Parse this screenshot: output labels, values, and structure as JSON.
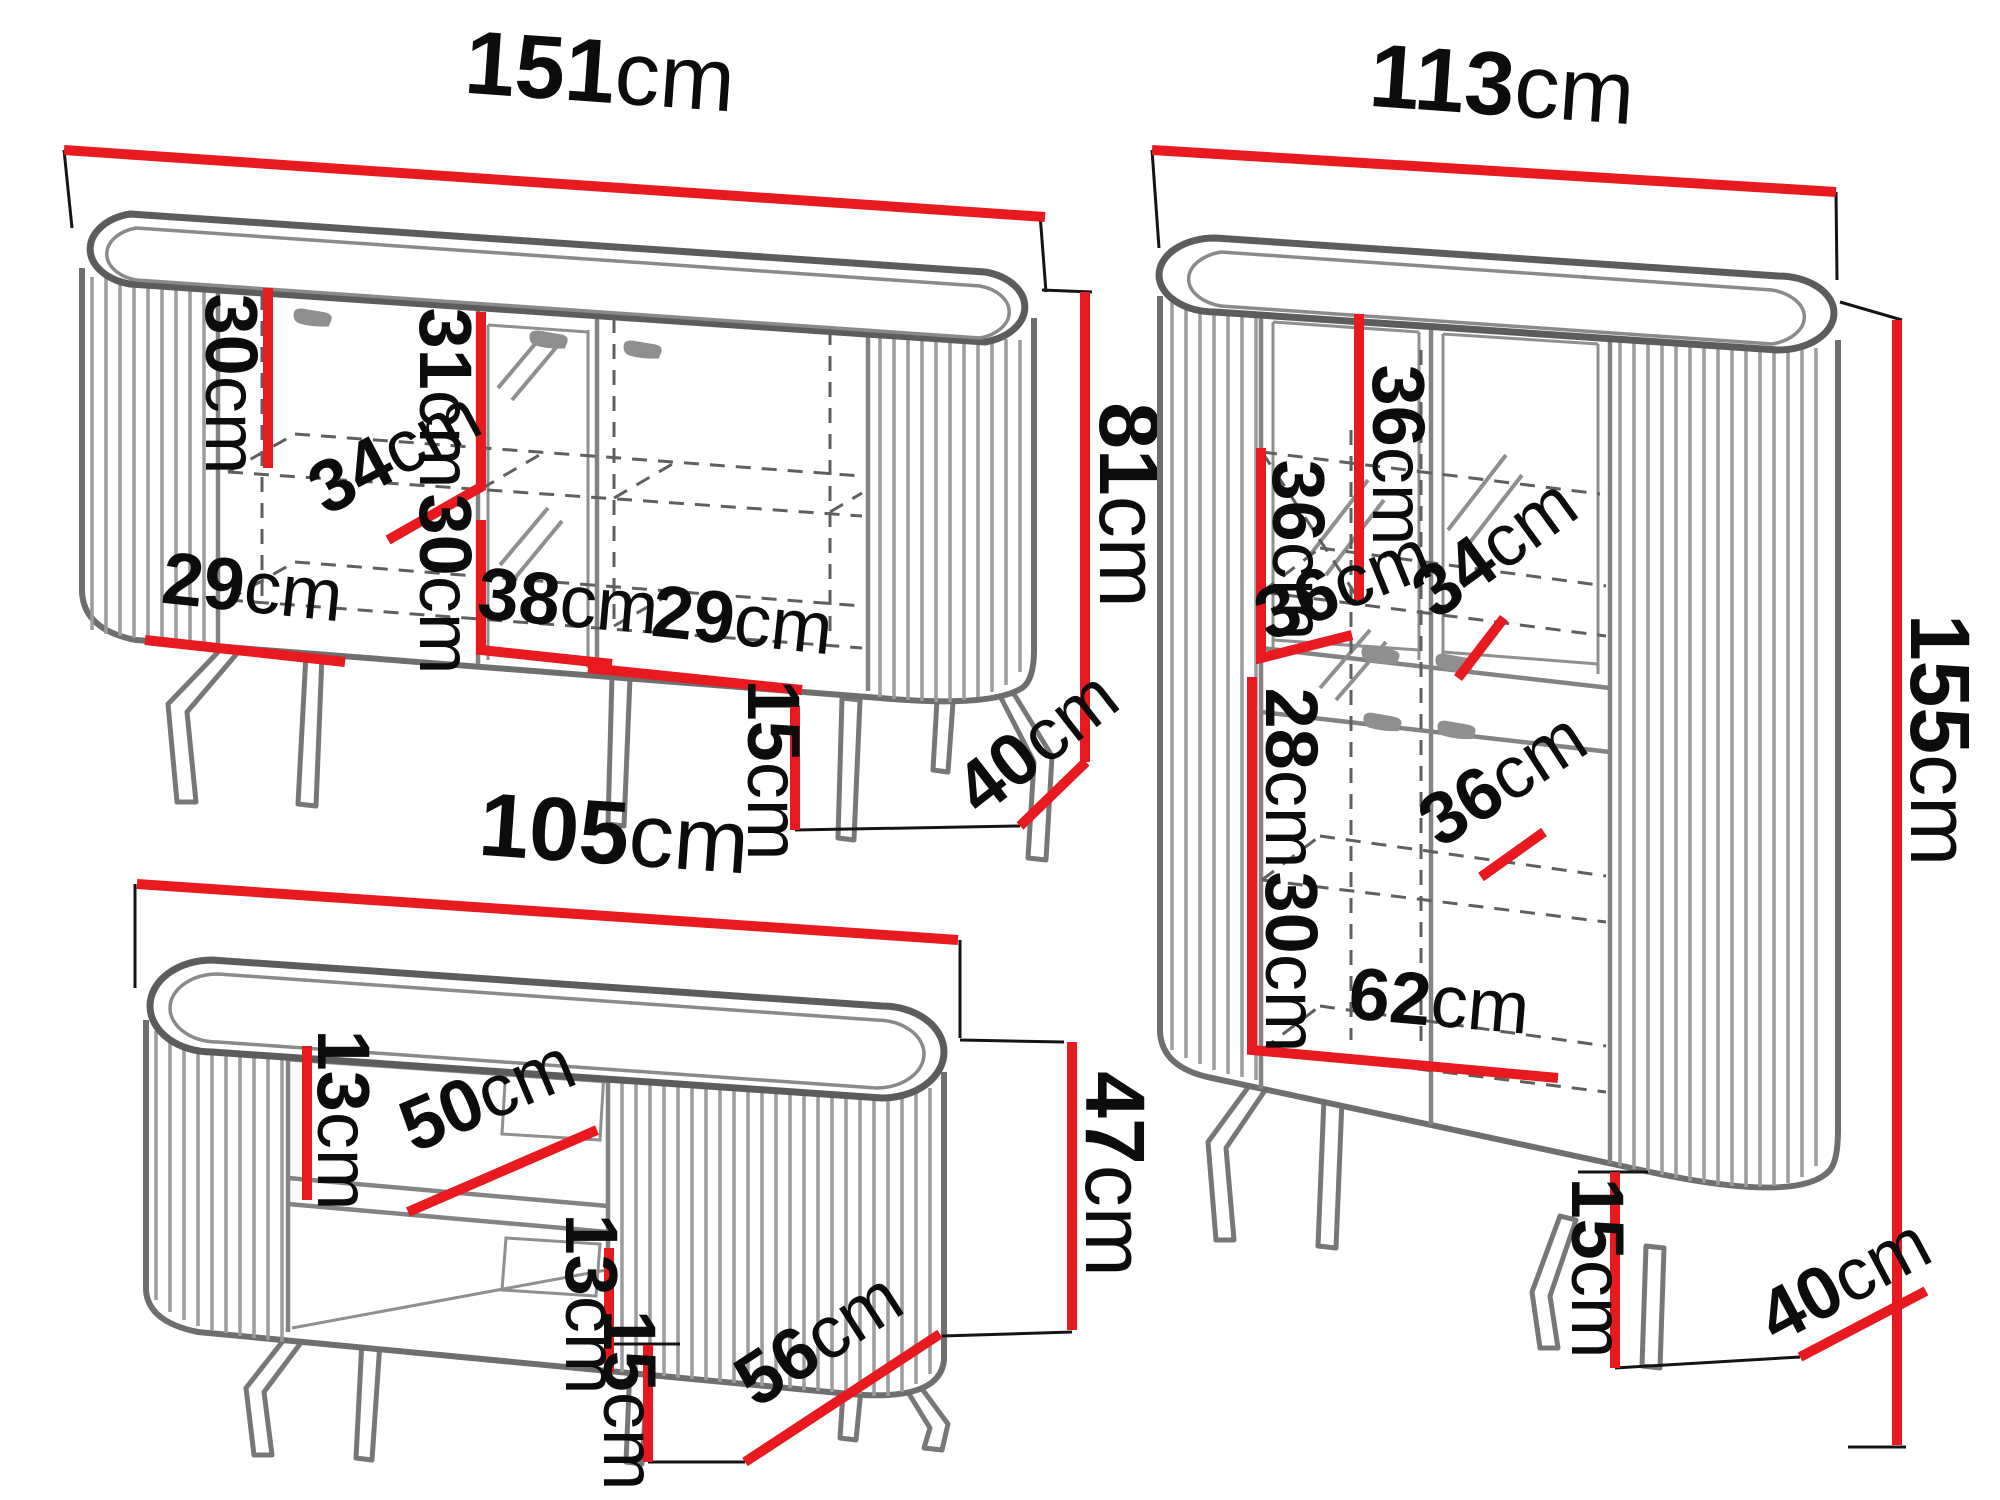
{
  "palette": {
    "dimension_red": "#e8191f",
    "outline_gray": "#6e6e6e",
    "flute_gray": "#9c9c9c",
    "text_black": "#0c0c0c",
    "background": "#ffffff"
  },
  "pieces": {
    "sideboard": {
      "width": {
        "num": "151",
        "unit": "cm"
      },
      "inner_top_left": {
        "num": "30",
        "unit": "cm"
      },
      "inner_top_mid": {
        "num": "31",
        "unit": "cm"
      },
      "shelf_depth": {
        "num": "34",
        "unit": "cm"
      },
      "inner_bottom_mid": {
        "num": "30",
        "unit": "cm"
      },
      "mid_compartment_width": {
        "num": "38",
        "unit": "cm"
      },
      "left_compartment_width": {
        "num": "29",
        "unit": "cm"
      },
      "right_compartment_width": {
        "num": "29",
        "unit": "cm"
      },
      "height": {
        "num": "81",
        "unit": "cm"
      },
      "leg_height": {
        "num": "15",
        "unit": "cm"
      },
      "depth": {
        "num": "40",
        "unit": "cm"
      }
    },
    "cabinet": {
      "width": {
        "num": "113",
        "unit": "cm"
      },
      "top_shelf_height": {
        "num": "36",
        "unit": "cm"
      },
      "top_shelf_depth": {
        "num": "34",
        "unit": "cm"
      },
      "mid_shelf_height": {
        "num": "36",
        "unit": "cm"
      },
      "mid_shelf_depth": {
        "num": "36",
        "unit": "cm"
      },
      "lower_shelf_height": {
        "num": "28",
        "unit": "cm"
      },
      "lower_shelf_depth": {
        "num": "36",
        "unit": "cm"
      },
      "bottom_shelf_height": {
        "num": "30",
        "unit": "cm"
      },
      "bottom_width": {
        "num": "62",
        "unit": "cm"
      },
      "height": {
        "num": "155",
        "unit": "cm"
      },
      "leg_height": {
        "num": "15",
        "unit": "cm"
      },
      "depth": {
        "num": "40",
        "unit": "cm"
      }
    },
    "table": {
      "width": {
        "num": "105",
        "unit": "cm"
      },
      "top_gap": {
        "num": "13",
        "unit": "cm"
      },
      "shelf_width": {
        "num": "50",
        "unit": "cm"
      },
      "bottom_gap": {
        "num": "13",
        "unit": "cm"
      },
      "height": {
        "num": "47",
        "unit": "cm"
      },
      "leg_height": {
        "num": "15",
        "unit": "cm"
      },
      "depth": {
        "num": "56",
        "unit": "cm"
      }
    }
  }
}
